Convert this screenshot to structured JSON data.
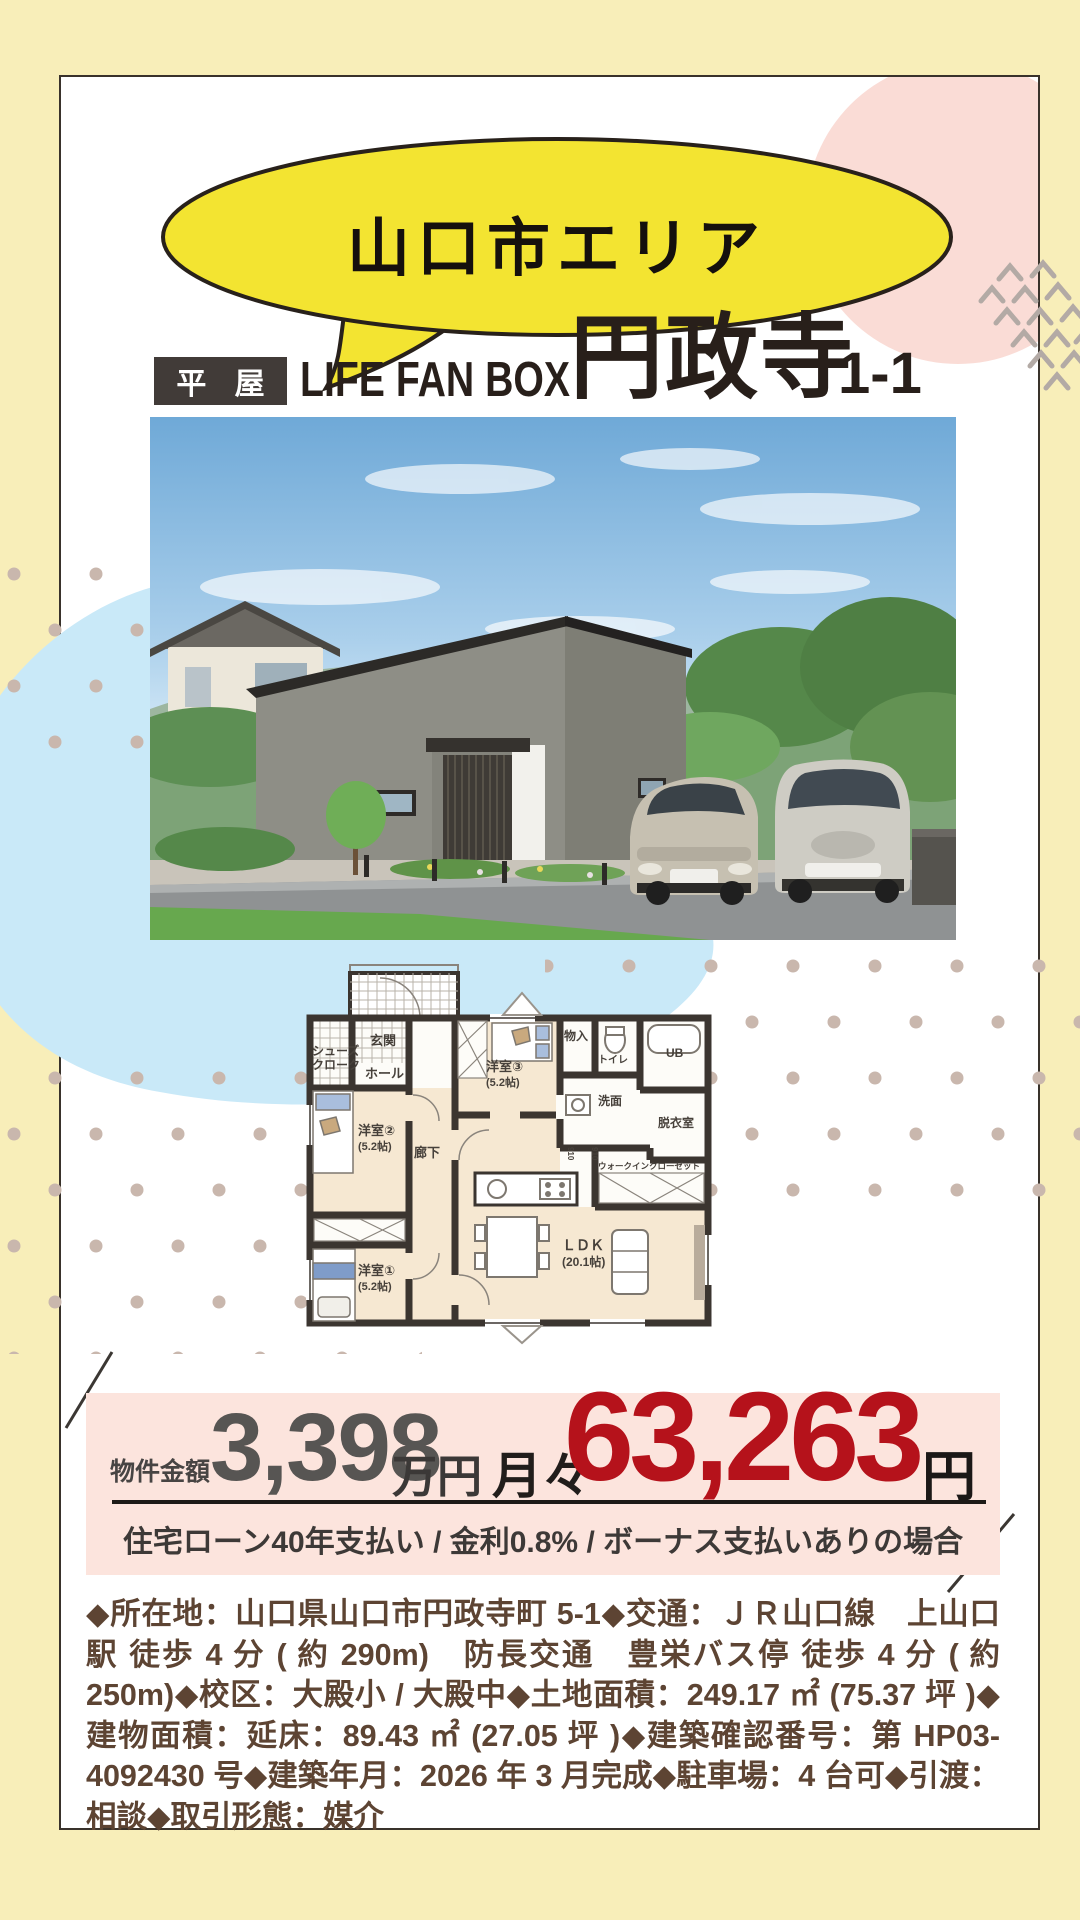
{
  "page": {
    "bg": "#f8eeb9"
  },
  "card": {
    "bg": "#ffffff",
    "border": "#39322b"
  },
  "bubble": {
    "label": "山口市エリア",
    "fill": "#f3e431",
    "stroke": "#28211b"
  },
  "decor": {
    "pink_circle": "#fadcd6",
    "blue_blob": "#c9e9f8",
    "dot_color": "#c9b7ad",
    "chevron_color": "#b3aaa5",
    "slash_color": "#3b3733"
  },
  "header": {
    "badge": "平 屋",
    "brand": "LIFE FAN BOX",
    "name": "円政寺",
    "lot": "1-1",
    "badge_bg": "#413b38",
    "text_color": "#281f1a"
  },
  "floorplan": {
    "rooms": {
      "shoes1": "シューズ",
      "shoes2": "クローク",
      "genkan": "玄関",
      "hall": "ホール",
      "room3": "洋室③",
      "room3_size": "(5.2帖)",
      "storage": "物入",
      "toilet": "トイレ",
      "bath": "UB",
      "senmen": "洗面",
      "datsui": "脱衣室",
      "room2": "洋室②",
      "room2_size": "(5.2帖)",
      "corridor": "廊下",
      "wic": "ウォークインクローゼット",
      "ldk": "ＬＤＫ",
      "ldk_size": "(20.1帖)",
      "room1": "洋室①",
      "room1_size": "(5.2帖)",
      "dim1": "910",
      "dim2": "910"
    }
  },
  "price": {
    "label": "物件金額",
    "amount": "3,398",
    "amount_unit": "万円",
    "monthly_label": "月々",
    "monthly_amount": "63,263",
    "monthly_unit": "円",
    "note": "住宅ローン40年支払い / 金利0.8% / ボーナス支払いありの場合",
    "band_bg": "#fce4dd",
    "accent": "#b5121b",
    "amount_color": "#575553"
  },
  "details": {
    "text": "◆所在地：山口県山口市円政寺町 5-1◆交通：ＪＲ山口線　上山口駅 徒歩 4 分 ( 約 290m)　防長交通　豊栄バス停 徒歩 4 分 ( 約 250m)◆校区：大殿小 / 大殿中◆土地面積：249.17 ㎡ (75.37 坪 )◆建物面積：延床：89.43 ㎡ (27.05 坪 )◆建築確認番号：第 HP03-4092430 号◆建築年月：2026 年 3 月完成◆駐車場：4 台可◆引渡：相談◆取引形態：媒介",
    "color": "#5d4433"
  }
}
